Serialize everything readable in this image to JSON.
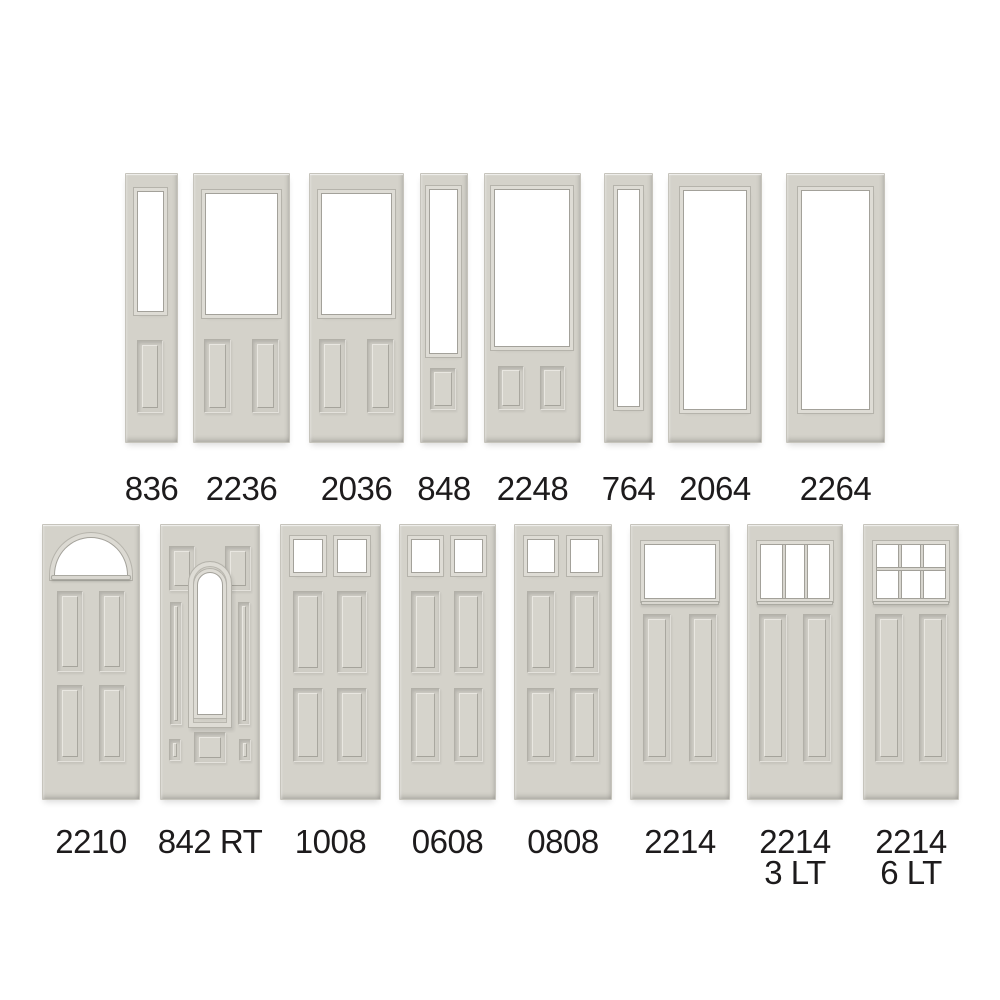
{
  "figure": {
    "background_color": "#ffffff",
    "door_face_color": "#d4d2ca",
    "glass_color": "#ffffff",
    "label_color": "#1d1b1c"
  },
  "rows": [
    {
      "doors": [
        {
          "model": "836",
          "style": "sidelight-half-glass-one-panel"
        },
        {
          "model": "2236",
          "style": "half-glass-two-panel"
        },
        {
          "model": "2036",
          "style": "half-glass-two-panel"
        },
        {
          "model": "848",
          "style": "sidelight-three-quarter-glass-one-panel"
        },
        {
          "model": "2248",
          "style": "three-quarter-glass-two-panel"
        },
        {
          "model": "764",
          "style": "sidelight-full-glass"
        },
        {
          "model": "2064",
          "style": "full-glass"
        },
        {
          "model": "2264",
          "style": "full-glass-wide"
        }
      ]
    },
    {
      "doors": [
        {
          "model": "2210",
          "style": "fan-lite-four-panel"
        },
        {
          "model": "842 RT",
          "style": "arch-lite-decorative-panel"
        },
        {
          "model": "1008",
          "style": "two-lite-four-panel"
        },
        {
          "model": "0608",
          "style": "two-lite-four-panel"
        },
        {
          "model": "0808",
          "style": "two-lite-four-panel"
        },
        {
          "model": "2214",
          "style": "craftsman-one-lite-two-panel"
        },
        {
          "model": "2214",
          "sublabel": "3 LT",
          "style": "craftsman-three-lite-two-panel"
        },
        {
          "model": "2214",
          "sublabel": "6 LT",
          "style": "craftsman-six-lite-two-panel"
        }
      ]
    }
  ]
}
